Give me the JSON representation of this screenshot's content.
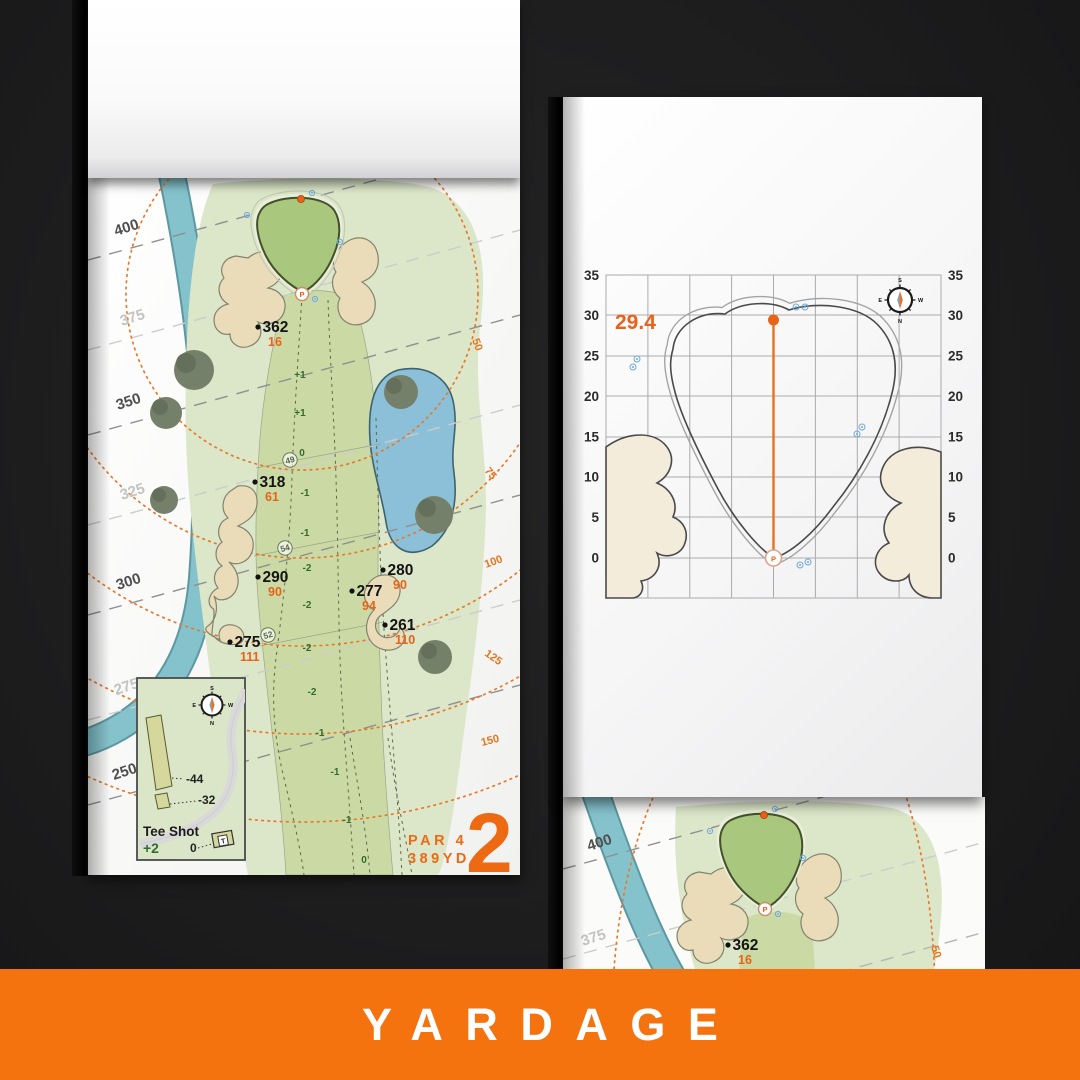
{
  "banner": {
    "label": "YARDAGE",
    "bg_color": "#F4730E"
  },
  "left_page": {
    "hole_number": "2",
    "par_label": "PAR 4",
    "yards_label": "389YD",
    "distance_labels": [
      "400",
      "375",
      "350",
      "325",
      "300",
      "275",
      "250"
    ],
    "arc_labels": [
      "50",
      "75",
      "100",
      "125",
      "150"
    ],
    "markers": [
      {
        "carry": "362",
        "to_pin": "16"
      },
      {
        "carry": "318",
        "to_pin": "61"
      },
      {
        "carry": "290",
        "to_pin": "90"
      },
      {
        "carry": "280",
        "to_pin": "90"
      },
      {
        "carry": "277",
        "to_pin": "94"
      },
      {
        "carry": "261",
        "to_pin": "110"
      },
      {
        "carry": "275",
        "to_pin": "111"
      }
    ],
    "slope_values": [
      "+1",
      "+1",
      "0",
      "-1",
      "-1",
      "-2",
      "-2",
      "-2",
      "-2",
      "-1",
      "-1",
      "-1",
      "0"
    ],
    "circled_values": [
      "49",
      "54",
      "52"
    ],
    "pin_label": "P",
    "compass": {
      "n": "N",
      "s": "S",
      "e": "E",
      "w": "W"
    },
    "tee_inset": {
      "title": "Tee Shot",
      "score": "+2",
      "zero_label": "0",
      "back_offset": "-44",
      "front_offset": "-32",
      "tee_label": "T"
    }
  },
  "right_page": {
    "green_depth": "29.4",
    "tick_labels": [
      "35",
      "30",
      "25",
      "20",
      "15",
      "10",
      "5",
      "0"
    ],
    "pin_label": "P",
    "compass": {
      "n": "N",
      "s": "S",
      "e": "E",
      "w": "W"
    }
  },
  "next_page": {
    "distance_labels": [
      "400",
      "375"
    ],
    "arc_label": "50",
    "marker": {
      "carry": "362",
      "to_pin": "16"
    }
  }
}
